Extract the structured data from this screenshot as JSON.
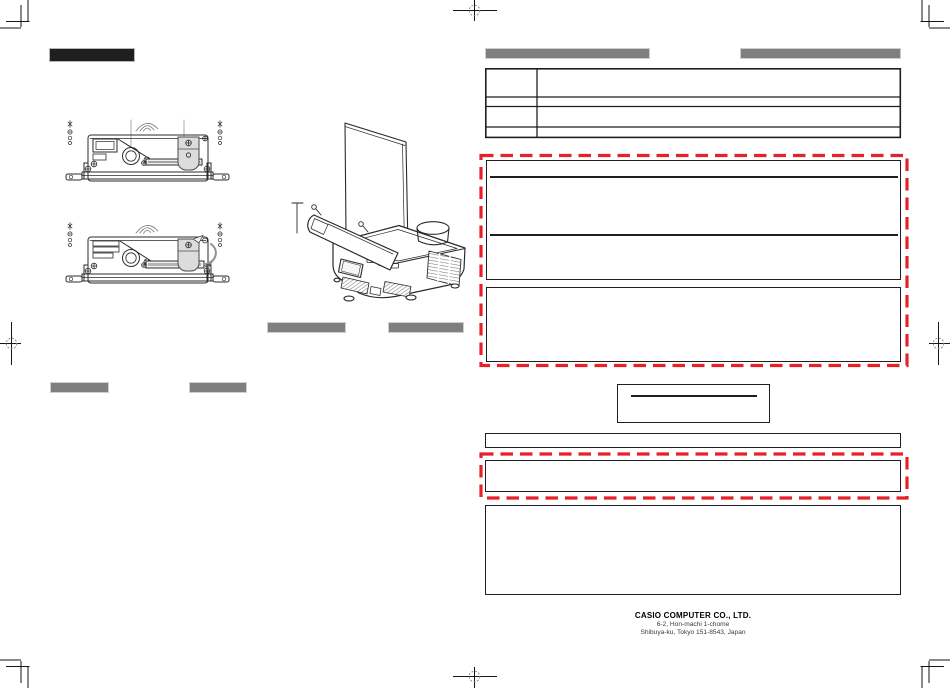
{
  "footer": {
    "company": "CASIO COMPUTER CO., LTD.",
    "address_line1": "6-2, Hon-machi 1-chome",
    "address_line2": "Shibuya-ku, Tokyo 151-8543, Japan"
  },
  "colors": {
    "page_bg": "#ffffff",
    "ink": "#1f1f1f",
    "redacted_gray": "#7f7f7f",
    "dashed_red": "#e62129",
    "drawing_line": "#2b2b2b",
    "callout_gray": "#a9a9a9"
  },
  "icons": {
    "center_trim_mark": "crosshair-with-dashed-circle",
    "corner_trim_mark": "double-corner-trim-lines",
    "screw_icon": "circle-with-cross",
    "insert_arrow_icon": "curved-gray-arrow"
  }
}
